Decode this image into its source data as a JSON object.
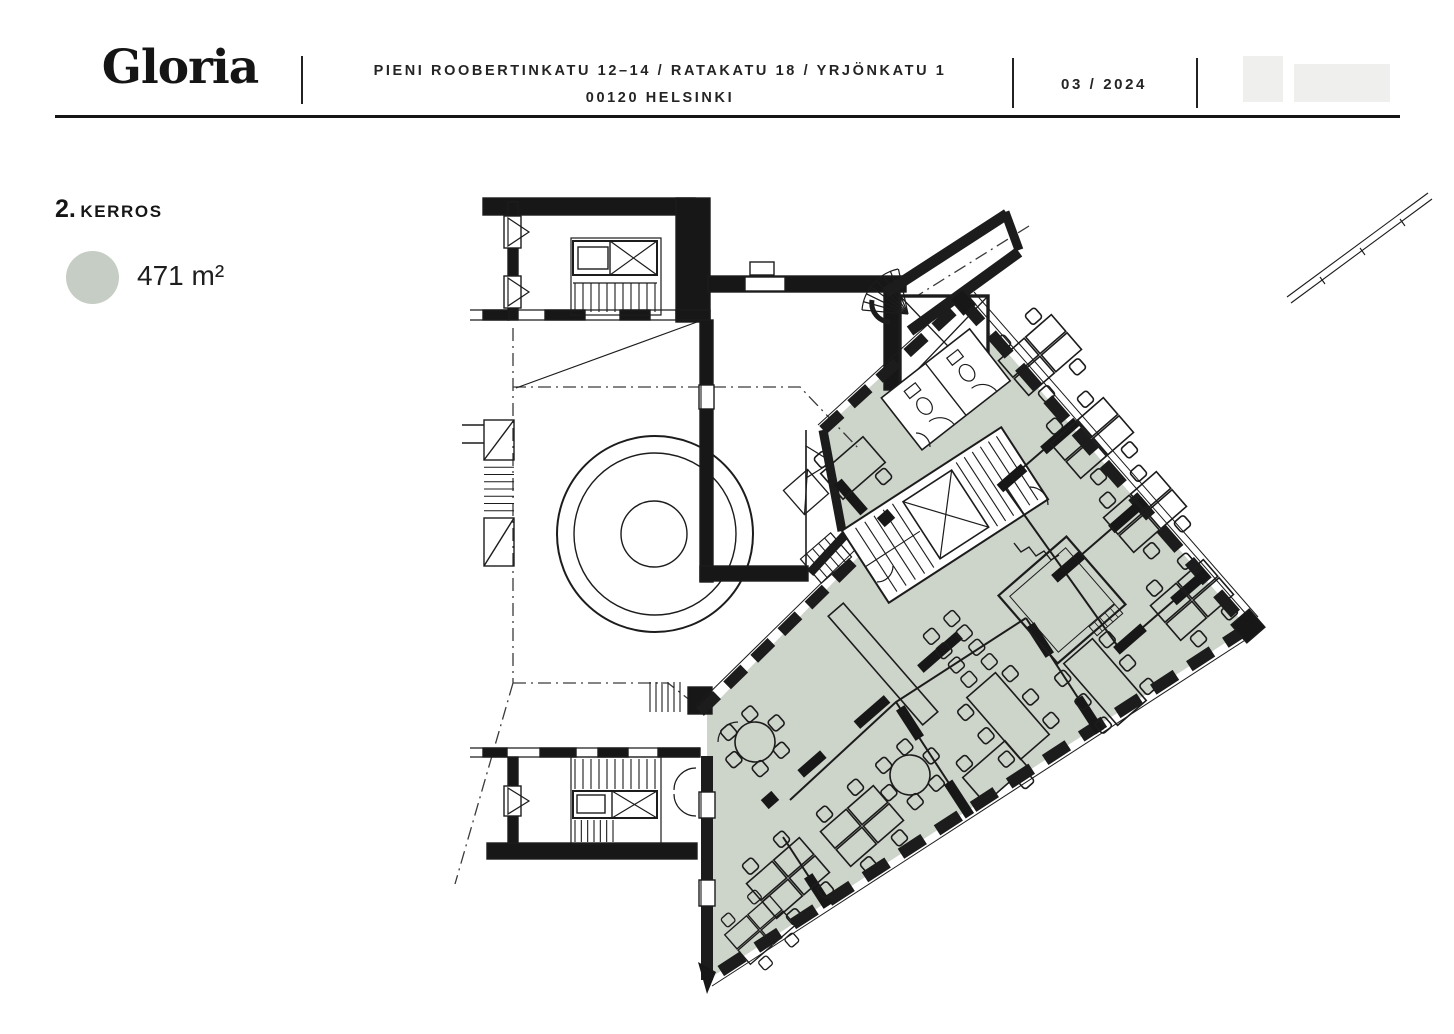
{
  "header": {
    "logo_text": "Gloria",
    "address_line1": "PIENI ROOBERTINKATU 12–14 / RATAKATU 18 / YRJÖNKATU 1",
    "address_line2": "00120 HELSINKI",
    "date": "03 / 2024"
  },
  "floor_info": {
    "floor_number": "2.",
    "floor_word": "KERROS",
    "area": "471 m²"
  },
  "plan": {
    "highlight_color": "#cdd4ca",
    "legend_swatch_color": "#c6cdc4",
    "wall_color": "#171717",
    "thin_line_color": "#2a2a2a",
    "highlighted_area_name": "office-wing-highlight"
  }
}
